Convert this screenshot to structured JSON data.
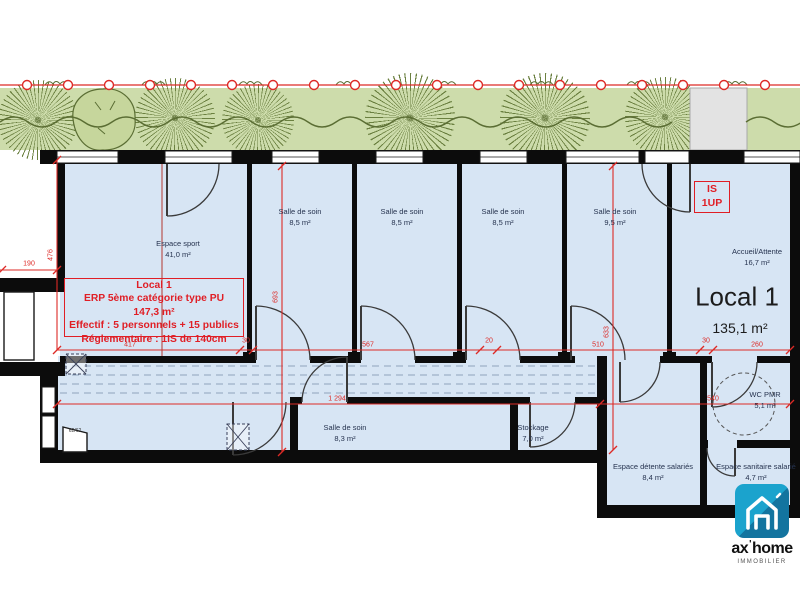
{
  "annotation": {
    "line1": "Local 1",
    "line2": "ERP 5ème catégorie type PU",
    "line3": "147,3 m²",
    "line4": "Effectif : 5 personnels + 15 publics",
    "line5": "Réglementaire : 1IS de 140cm"
  },
  "is_marker": {
    "line1": "IS",
    "line2": "1UP"
  },
  "local_label": {
    "name": "Local 1",
    "area": "135,1 m²"
  },
  "rooms": [
    {
      "name": "Espace sport",
      "area": "41,0 m²"
    },
    {
      "name": "Salle de soin",
      "area": "8,5 m²"
    },
    {
      "name": "Salle de soin",
      "area": "8,5 m²"
    },
    {
      "name": "Salle de soin",
      "area": "8,5 m²"
    },
    {
      "name": "Salle de soin",
      "area": "9,5 m²"
    },
    {
      "name": "Accueil/Attente",
      "area": "16,7 m²"
    },
    {
      "name": "Salle de soin",
      "area": "8,3 m²"
    },
    {
      "name": "Stockage",
      "area": "7,0 m²"
    },
    {
      "name": "WC PMR",
      "area": "5,1 m²"
    },
    {
      "name": "Espace détente salariés",
      "area": "8,4 m²"
    },
    {
      "name": "Espace sanitaire salarié",
      "area": "4,7 m²"
    }
  ],
  "dims": {
    "d190": "190",
    "d476": "476",
    "d693": "693",
    "d633": "633",
    "d417": "417",
    "d30a": "30",
    "d567": "567",
    "d20": "20",
    "d510": "510",
    "d30b": "30",
    "d260": "260",
    "d1294": "1 294",
    "d540": "540",
    "door_note": "62/62"
  },
  "logo": {
    "brand_left": "ax",
    "mark": "'",
    "brand_right": "home",
    "subtitle": "IMMOBILIER"
  },
  "colors": {
    "floor_blue": "#d7e5f4",
    "wall_black": "#0c0c0c",
    "dimension_red": "#dd2a26",
    "landscape_green": "#cddcab",
    "tree_green": "#6b8040",
    "logo_teal": "#1ba3cd"
  }
}
